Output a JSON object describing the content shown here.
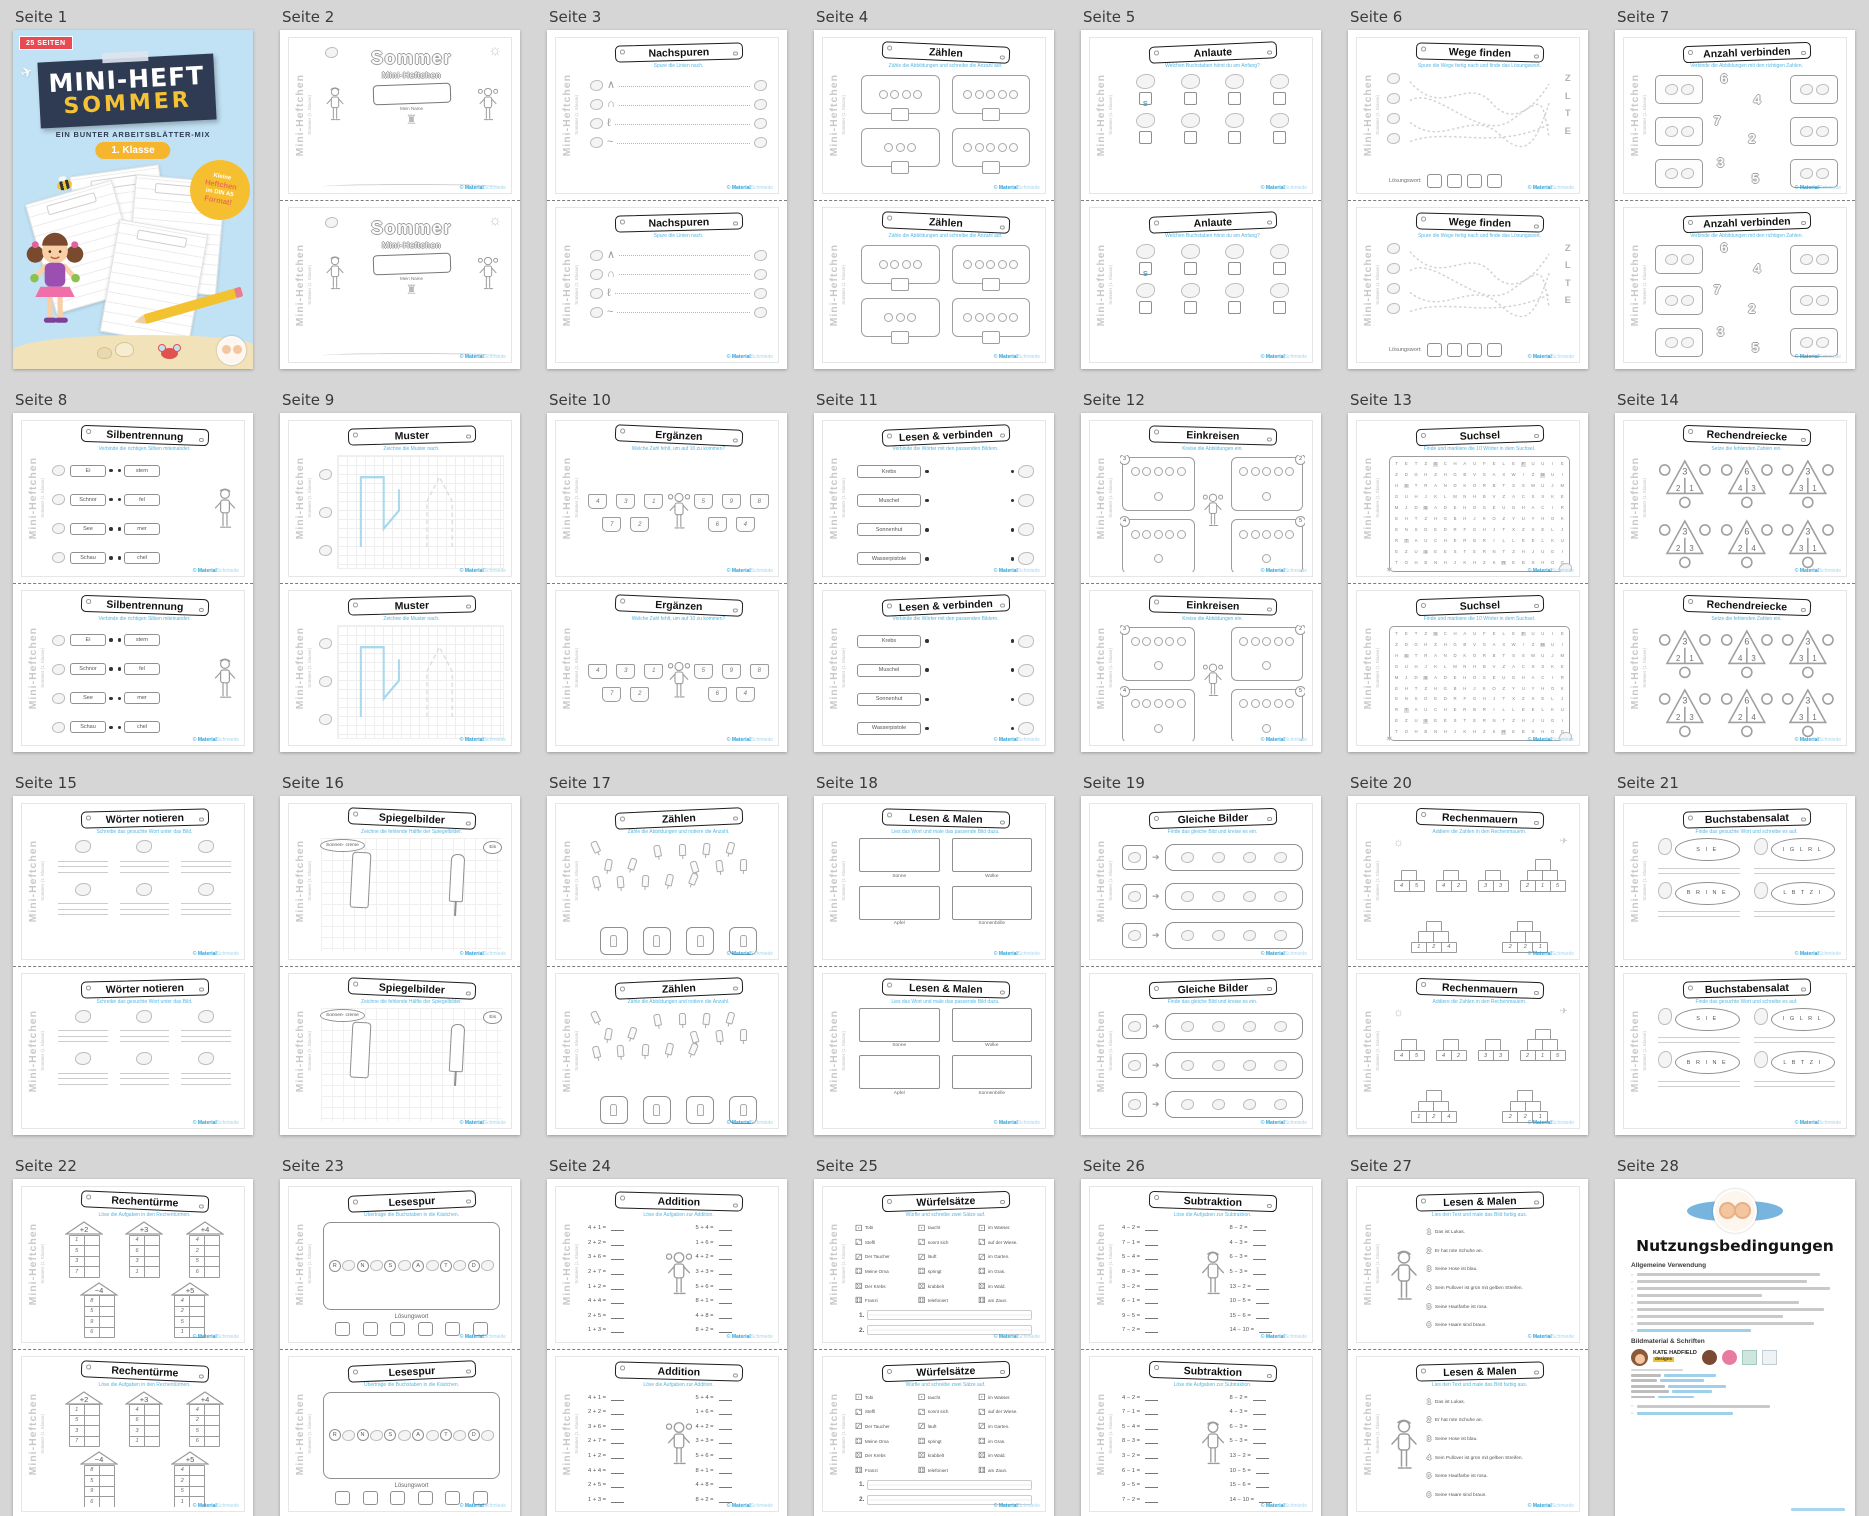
{
  "background": "#d6d6d6",
  "side": {
    "main": "Mini-Heftchen",
    "sub": "Sommer (1. Klasse)"
  },
  "footer": {
    "copy": "©",
    "brand_a": "Material",
    "brand_b": "Schmiede"
  },
  "pages": [
    {
      "label": "Seite 1",
      "type": "cover",
      "cover": {
        "badge": "25 SEITEN",
        "line1": "MINI-HEFT",
        "line2": "SOMMER",
        "sub": "EIN BUNTER ARBEITSBLÄTTER-MIX",
        "pill": "1. Klasse",
        "sticker_lines": [
          "Kleine",
          "Heftchen",
          "im DIN A5",
          "Format!"
        ]
      }
    },
    {
      "label": "Seite 2",
      "type": "sheet",
      "sheet": {
        "kind": "minicover",
        "big": "Sommer",
        "mid": "Mini-Heftchen",
        "name_label": "Mein Name"
      }
    },
    {
      "label": "Seite 3",
      "type": "sheet",
      "sheet": {
        "kind": "trace",
        "title": "Nachspuren",
        "subtitle": "Spure die Linien nach.",
        "glyphs": [
          "∧",
          "∩",
          "ℓ",
          "~"
        ]
      }
    },
    {
      "label": "Seite 4",
      "type": "sheet",
      "sheet": {
        "kind": "count4",
        "title": "Zählen",
        "subtitle": "Zähle die Abbildungen und schreibe die Anzahl auf.",
        "counts": [
          4,
          5,
          3,
          5
        ]
      }
    },
    {
      "label": "Seite 5",
      "type": "sheet",
      "sheet": {
        "kind": "anlaute",
        "title": "Anlaute",
        "subtitle": "Welchen Buchstaben hörst du am Anfang?",
        "example": "S"
      }
    },
    {
      "label": "Seite 6",
      "type": "sheet",
      "sheet": {
        "kind": "maze",
        "title": "Wege finden",
        "subtitle": "Spure die Wege fertig nach und finde das Lösungswort.",
        "letters": [
          "Z",
          "L",
          "T",
          "E"
        ],
        "solution_label": "Lösungswort:"
      }
    },
    {
      "label": "Seite 7",
      "type": "sheet",
      "sheet": {
        "kind": "matchnum",
        "title": "Anzahl verbinden",
        "subtitle": "Verbinde die Abbildungen mit den richtigen Zahlen.",
        "numbers": [
          "6",
          "4",
          "7",
          "2",
          "3",
          "5"
        ]
      }
    },
    {
      "label": "Seite 8",
      "type": "sheet",
      "sheet": {
        "kind": "syllables",
        "title": "Silbentrennung",
        "subtitle": "Verbinde die richtigen Silben miteinander.",
        "left": [
          "Ei",
          "Schnor",
          "See",
          "Schau"
        ],
        "right": [
          "stern",
          "fel",
          "mer",
          "chel"
        ]
      }
    },
    {
      "label": "Seite 9",
      "type": "sheet",
      "sheet": {
        "kind": "pattern",
        "title": "Muster",
        "subtitle": "Zeichne die Muster nach."
      }
    },
    {
      "label": "Seite 10",
      "type": "sheet",
      "sheet": {
        "kind": "buckets",
        "title": "Ergänzen",
        "subtitle": "Welche Zahl fehlt, um auf 10 zu kommen?",
        "nums": [
          "4",
          "3",
          "1",
          "7",
          "2",
          "5",
          "9",
          "8",
          "6",
          "4"
        ]
      }
    },
    {
      "label": "Seite 11",
      "type": "sheet",
      "sheet": {
        "kind": "readconnect",
        "title": "Lesen & verbinden",
        "subtitle": "Verbinde die Wörter mit den passenden Bildern.",
        "words": [
          "Krebs",
          "Muschel",
          "Sonnenhut",
          "Wasserpistole"
        ]
      }
    },
    {
      "label": "Seite 12",
      "type": "sheet",
      "sheet": {
        "kind": "circle4",
        "title": "Einkreisen",
        "subtitle": "Kreise die Abbildungen ein.",
        "nums": [
          "3",
          "2",
          "4",
          "5"
        ]
      }
    },
    {
      "label": "Seite 13",
      "type": "sheet",
      "sheet": {
        "kind": "suchsel",
        "title": "Suchsel",
        "subtitle": "Finde und markiere die 10 Wörter in dem Suchsel.",
        "rows": [
          "TETZSCHAUFELEFUUIE",
          "ZDGHZHGBVSAXWIZMUI",
          "HSTRANDKORBTSSWUJM",
          "GUHJKLMNHBVZACSSKE",
          "MJDBADEHOSEUGHACIR",
          "EHTZHGBHJKOZYUYHOK",
          "ENSDEDRFGHJTXZXELJ",
          "RTAUCHERBRILLEELKU",
          "EZUSEESTERNTZHJUGI",
          "TOHBNHJKHZKREBSHOG"
        ]
      }
    },
    {
      "label": "Seite 14",
      "type": "sheet",
      "sheet": {
        "kind": "triangles",
        "title": "Rechendreiecke",
        "subtitle": "Setze die fehlenden Zahlen ein.",
        "t": [
          {
            "top": "3",
            "l": "2",
            "r": "1"
          },
          {
            "top": "6",
            "l": "4",
            "r": "3"
          },
          {
            "top": "3",
            "l": "3",
            "r": "1"
          },
          {
            "top": "3",
            "l": "2",
            "r": "3"
          },
          {
            "top": "6",
            "l": "2",
            "r": "4"
          },
          {
            "top": "3",
            "l": "3",
            "r": "1"
          }
        ]
      }
    },
    {
      "label": "Seite 15",
      "type": "sheet",
      "sheet": {
        "kind": "write6",
        "title": "Wörter notieren",
        "subtitle": "Schreibe das gesuchte Wort unter das Bild."
      }
    },
    {
      "label": "Seite 16",
      "type": "sheet",
      "sheet": {
        "kind": "mirror",
        "title": "Spiegelbilder",
        "subtitle": "Zeichne die fehlende Hälfte der Spiegelbilder.",
        "bubbles": [
          "Sonnen- creme",
          "Eis"
        ]
      }
    },
    {
      "label": "Seite 17",
      "type": "sheet",
      "sheet": {
        "kind": "scatter",
        "title": "Zählen",
        "subtitle": "Zähle die Abbildungen und notiere die Anzahl."
      }
    },
    {
      "label": "Seite 18",
      "type": "sheet",
      "sheet": {
        "kind": "readdraw",
        "title": "Lesen & Malen",
        "subtitle": "Lies das Wort und male das passende Bild dazu.",
        "labels": [
          "Sonne",
          "Wolke",
          "Apfel",
          "Sonnenbrille"
        ]
      }
    },
    {
      "label": "Seite 19",
      "type": "sheet",
      "sheet": {
        "kind": "same3",
        "title": "Gleiche Bilder",
        "subtitle": "Finde das gleiche Bild und kreise es ein."
      }
    },
    {
      "label": "Seite 20",
      "type": "sheet",
      "sheet": {
        "kind": "walls",
        "title": "Rechenmauern",
        "subtitle": "Addiere die Zahlen in den Rechenmauern.",
        "w2": [
          [
            "4",
            "5"
          ],
          [
            "4",
            "2"
          ],
          [
            "3",
            "3"
          ]
        ],
        "w3": [
          [
            "2",
            "1",
            "5"
          ],
          [
            "1",
            "2",
            "4"
          ],
          [
            "2",
            "2",
            "1"
          ]
        ]
      }
    },
    {
      "label": "Seite 21",
      "type": "sheet",
      "sheet": {
        "kind": "salad",
        "title": "Buchstabensalat",
        "subtitle": "Finde das gesuchte Wort und schreibe es auf.",
        "items": [
          {
            "letters": "S I E"
          },
          {
            "letters": "I G L R L"
          },
          {
            "letters": "B R I N E"
          },
          {
            "letters": "L B T Z I"
          }
        ]
      }
    },
    {
      "label": "Seite 22",
      "type": "sheet",
      "sheet": {
        "kind": "towers",
        "title": "Rechentürme",
        "subtitle": "Löse die Aufgaben in den Rechentürmen.",
        "towers": [
          {
            "op": "+2",
            "vals": [
              "1",
              "5",
              "3",
              "7"
            ]
          },
          {
            "op": "+3",
            "vals": [
              "4",
              "6",
              "3",
              "1"
            ]
          },
          {
            "op": "+4",
            "vals": [
              "4",
              "2",
              "5",
              "6"
            ]
          },
          {
            "op": "−4",
            "vals": [
              "8",
              "5",
              "9",
              "6"
            ]
          },
          {
            "op": "+5",
            "vals": [
              "4",
              "2",
              "5",
              "1"
            ]
          }
        ]
      }
    },
    {
      "label": "Seite 23",
      "type": "sheet",
      "sheet": {
        "kind": "lesespur",
        "title": "Lesespur",
        "subtitle": "Übertrage die Buchstaben in die Kästchen.",
        "letters": [
          "R",
          "N",
          "S",
          "A",
          "T",
          "D"
        ],
        "solution_label": "Lösungswort"
      }
    },
    {
      "label": "Seite 24",
      "type": "sheet",
      "sheet": {
        "kind": "equations",
        "title": "Addition",
        "subtitle": "Löse die Aufgaben zur Addition.",
        "figure": "girl",
        "left": [
          "4 + 1 =",
          "2 + 2 =",
          "3 + 6 =",
          "2 + 7 =",
          "1 + 2 =",
          "4 + 4 =",
          "2 + 5 =",
          "1 + 3 ="
        ],
        "right": [
          "5 + 4 =",
          "1 + 6 =",
          "4 + 2 =",
          "3 + 3 =",
          "5 + 6 =",
          "8 + 1 =",
          "4 + 8 =",
          "8 + 2 ="
        ]
      }
    },
    {
      "label": "Seite 25",
      "type": "sheet",
      "sheet": {
        "kind": "dice",
        "title": "Würfelsätze",
        "subtitle": "Würfle und schreibe zwei Sätze auf.",
        "col1": [
          "Tobi",
          "Steffi",
          "Der Taucher",
          "Meine Oma",
          "Der Krebs",
          "Franzi"
        ],
        "col2": [
          "taucht",
          "sonnt sich",
          "läuft",
          "springt",
          "krabbelt",
          "telefoniert"
        ],
        "col3": [
          "im Wasser.",
          "auf der Wiese.",
          "im Garten.",
          "im Gras.",
          "im Wald.",
          "am Zaun."
        ],
        "line_labels": [
          "1.",
          "2."
        ]
      }
    },
    {
      "label": "Seite 26",
      "type": "sheet",
      "sheet": {
        "kind": "equations",
        "title": "Subtraktion",
        "subtitle": "Löse die Aufgaben zur Subtraktion.",
        "figure": "boy",
        "left": [
          "4 − 2 =",
          "7 − 1 =",
          "5 − 4 =",
          "8 − 3 =",
          "3 − 2 =",
          "6 − 1 =",
          "9 − 5 =",
          "7 − 2 ="
        ],
        "right": [
          "8 − 2 =",
          "4 − 3 =",
          "6 − 3 =",
          "5 − 3 =",
          "13 − 2 =",
          "10 − 5 =",
          "15 − 6 =",
          "14 − 10 ="
        ]
      }
    },
    {
      "label": "Seite 27",
      "type": "sheet",
      "sheet": {
        "kind": "readcolor",
        "title": "Lesen & Malen",
        "subtitle": "Lies den Text und male das Bild farbig aus.",
        "sentences": [
          {
            "n": "1",
            "t": "Das ist Lukas."
          },
          {
            "n": "2",
            "t": "Er hat rote Schuhe an."
          },
          {
            "n": "3",
            "t": "Seine Hose ist blau."
          },
          {
            "n": "4",
            "t": "Sein Pullover ist grün mit gelben Streifen."
          },
          {
            "n": "5",
            "t": "Seine Hautfarbe ist rosa."
          },
          {
            "n": "6",
            "t": "Seine Haare sind braun."
          }
        ]
      }
    },
    {
      "label": "Seite 28",
      "type": "terms",
      "terms": {
        "heading": "Nutzungsbedingungen",
        "s1": "Allgemeine Verwendung",
        "s2": "Bildmaterial & Schriften",
        "brand_line1": "KATE HADFIELD",
        "brand_line2": "designs"
      }
    }
  ]
}
